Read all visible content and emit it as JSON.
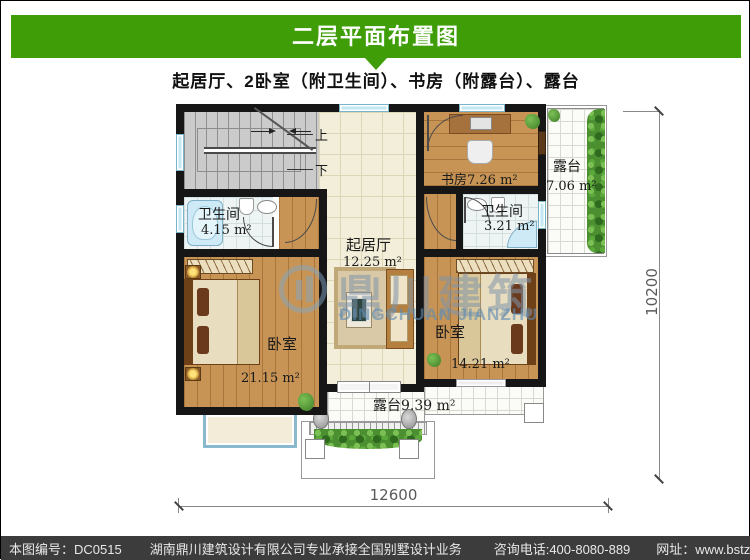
{
  "header": {
    "title": "二层平面布置图",
    "subtitle": "起居厅、2卧室（附卫生间）、书房（附露台）、露台"
  },
  "rooms": {
    "living": {
      "name": "起居厅",
      "area": "12.25 m²"
    },
    "study": {
      "label": "书房7.26 m²"
    },
    "bath_left": {
      "name": "卫生间",
      "area": "4.15 m²"
    },
    "bath_right": {
      "name": "卫生间",
      "area": "3.21 m²"
    },
    "bedroom_left": {
      "name": "卧室",
      "area": "21.15 m²"
    },
    "bedroom_right": {
      "name": "卧室",
      "area": "14.21 m²"
    },
    "terrace_right": {
      "name": "露台",
      "area": "7.06 m²"
    },
    "terrace_bottom": {
      "label": "露台9.39 m²"
    }
  },
  "stairs": {
    "up_label": "上",
    "down_label": "下"
  },
  "dimensions": {
    "width": "12600",
    "height": "10200"
  },
  "watermark": {
    "cn": "鼎川建筑",
    "en": "DINGCHUAN JIANZHU"
  },
  "footer": {
    "drawing_no": "本图编号：DC0515",
    "company": "湖南鼎川建筑设计有限公司专业承接全国别墅设计业务",
    "phone": "咨询电话:400-8080-889",
    "website": "网址：www.bstzcs.com"
  },
  "colors": {
    "header_green": "#3f9e08",
    "footer_bg": "#3c3c3c",
    "wall_black": "#161616",
    "window_blue": "#c3e7f3",
    "wood_floor": "#c79455",
    "tile_cream": "#f3eeda"
  }
}
